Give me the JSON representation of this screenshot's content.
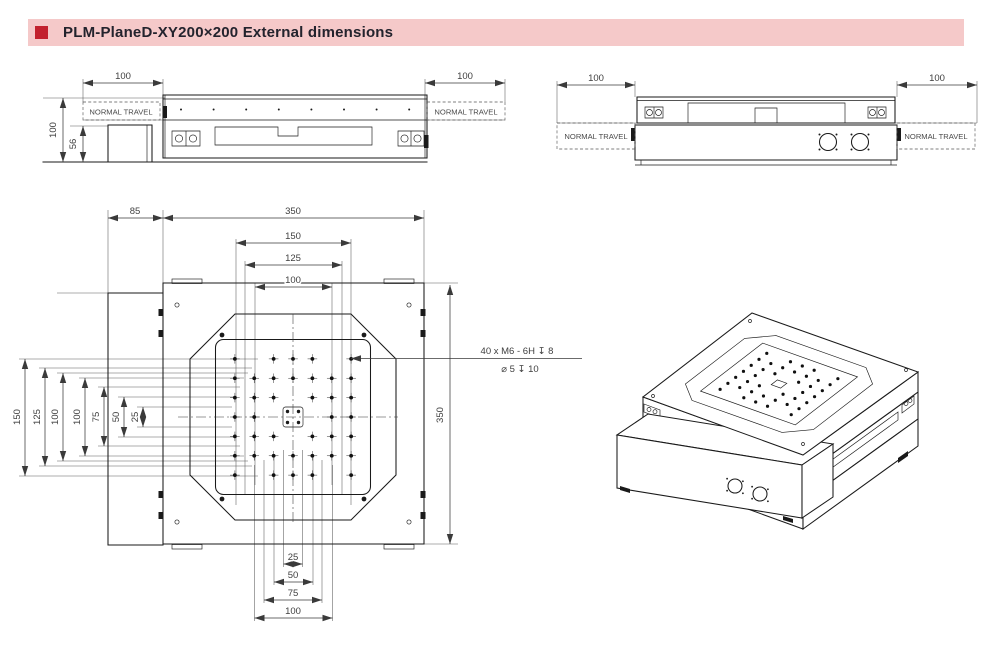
{
  "header": {
    "title": "PLM-PlaneD-XY200×200 External dimensions"
  },
  "colors": {
    "accent": "#c2212e",
    "header_bar": "#f5c9c9",
    "line": "#1a1a1a",
    "dim_text": "#3f3f3f"
  },
  "front_view": {
    "dim_height": "100",
    "dim_motor_height": "56",
    "dim_travel_left": "100",
    "dim_travel_right": "100",
    "travel_label_left": "NORMAL TRAVEL",
    "travel_label_right": "NORMAL TRAVEL"
  },
  "side_view": {
    "dim_travel_left": "100",
    "dim_travel_right": "100",
    "travel_label_left": "NORMAL TRAVEL",
    "travel_label_right": "NORMAL TRAVEL"
  },
  "plan_view": {
    "dim_base_offset": "85",
    "dim_width": "350",
    "dim_height": "350",
    "dims_top": [
      "150",
      "125",
      "100"
    ],
    "dims_left": [
      "150",
      "125",
      "100",
      "100",
      "75",
      "50",
      "25"
    ],
    "dims_bottom": [
      "25",
      "50",
      "75",
      "100"
    ],
    "thread_note_line1": "40 x M6 - 6H ↧ 8",
    "thread_note_line2": "⌀ 5 ↧ 10",
    "holes_mm": [
      [
        0,
        -50
      ],
      [
        0,
        -75
      ],
      [
        0,
        50
      ],
      [
        0,
        75
      ],
      [
        -50,
        0
      ],
      [
        -75,
        0
      ],
      [
        50,
        0
      ],
      [
        75,
        0
      ],
      [
        25,
        25
      ],
      [
        50,
        50
      ],
      [
        75,
        75
      ],
      [
        25,
        -25
      ],
      [
        50,
        -50
      ],
      [
        75,
        -75
      ],
      [
        -25,
        25
      ],
      [
        -50,
        50
      ],
      [
        -75,
        75
      ],
      [
        -25,
        -25
      ],
      [
        -50,
        -50
      ],
      [
        -75,
        -75
      ],
      [
        25,
        50
      ],
      [
        50,
        25
      ],
      [
        25,
        -50
      ],
      [
        50,
        -25
      ],
      [
        -25,
        50
      ],
      [
        -50,
        25
      ],
      [
        -25,
        -50
      ],
      [
        -50,
        -25
      ],
      [
        75,
        25
      ],
      [
        75,
        50
      ],
      [
        75,
        -25
      ],
      [
        75,
        -50
      ],
      [
        -75,
        25
      ],
      [
        -75,
        50
      ],
      [
        -75,
        -25
      ],
      [
        -75,
        -50
      ],
      [
        25,
        75
      ],
      [
        -25,
        75
      ],
      [
        25,
        -75
      ],
      [
        -25,
        -75
      ]
    ]
  }
}
